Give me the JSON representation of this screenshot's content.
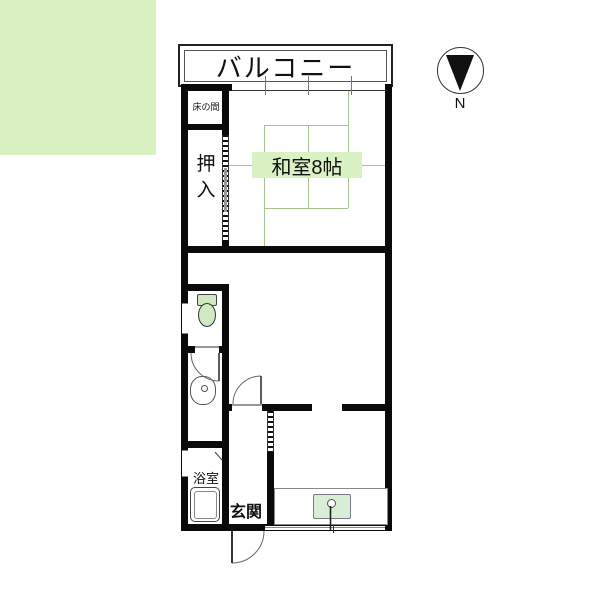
{
  "title": "apartment floor plan",
  "labels": {
    "balcony": "バルコニー",
    "north": "N",
    "tokonoma": "床の間",
    "closet_chars": [
      "押",
      "入"
    ],
    "washitsu": "和室8帖",
    "bathroom": "浴室",
    "entrance": "玄関"
  },
  "colors": {
    "wall": "#0a0a0a",
    "tatami_fill": "#daf1c4",
    "tatami_line": "#a6c28f",
    "fixture_green": "#cfe9c2",
    "sink_green": "#d9eed6",
    "background": "#ffffff"
  },
  "icons": {
    "north_arrow": "compass-wedge",
    "toilet": "toilet-icon",
    "washbasin": "washbasin-icon",
    "bathtub": "bathtub-icon",
    "kitchen_sink": "sink-icon",
    "doors": [
      "toilet-door-arc",
      "living-door-arc",
      "entrance-door-arc"
    ],
    "sliding_doors": [
      "closet-sliding-door",
      "genkan-sliding-door"
    ]
  }
}
